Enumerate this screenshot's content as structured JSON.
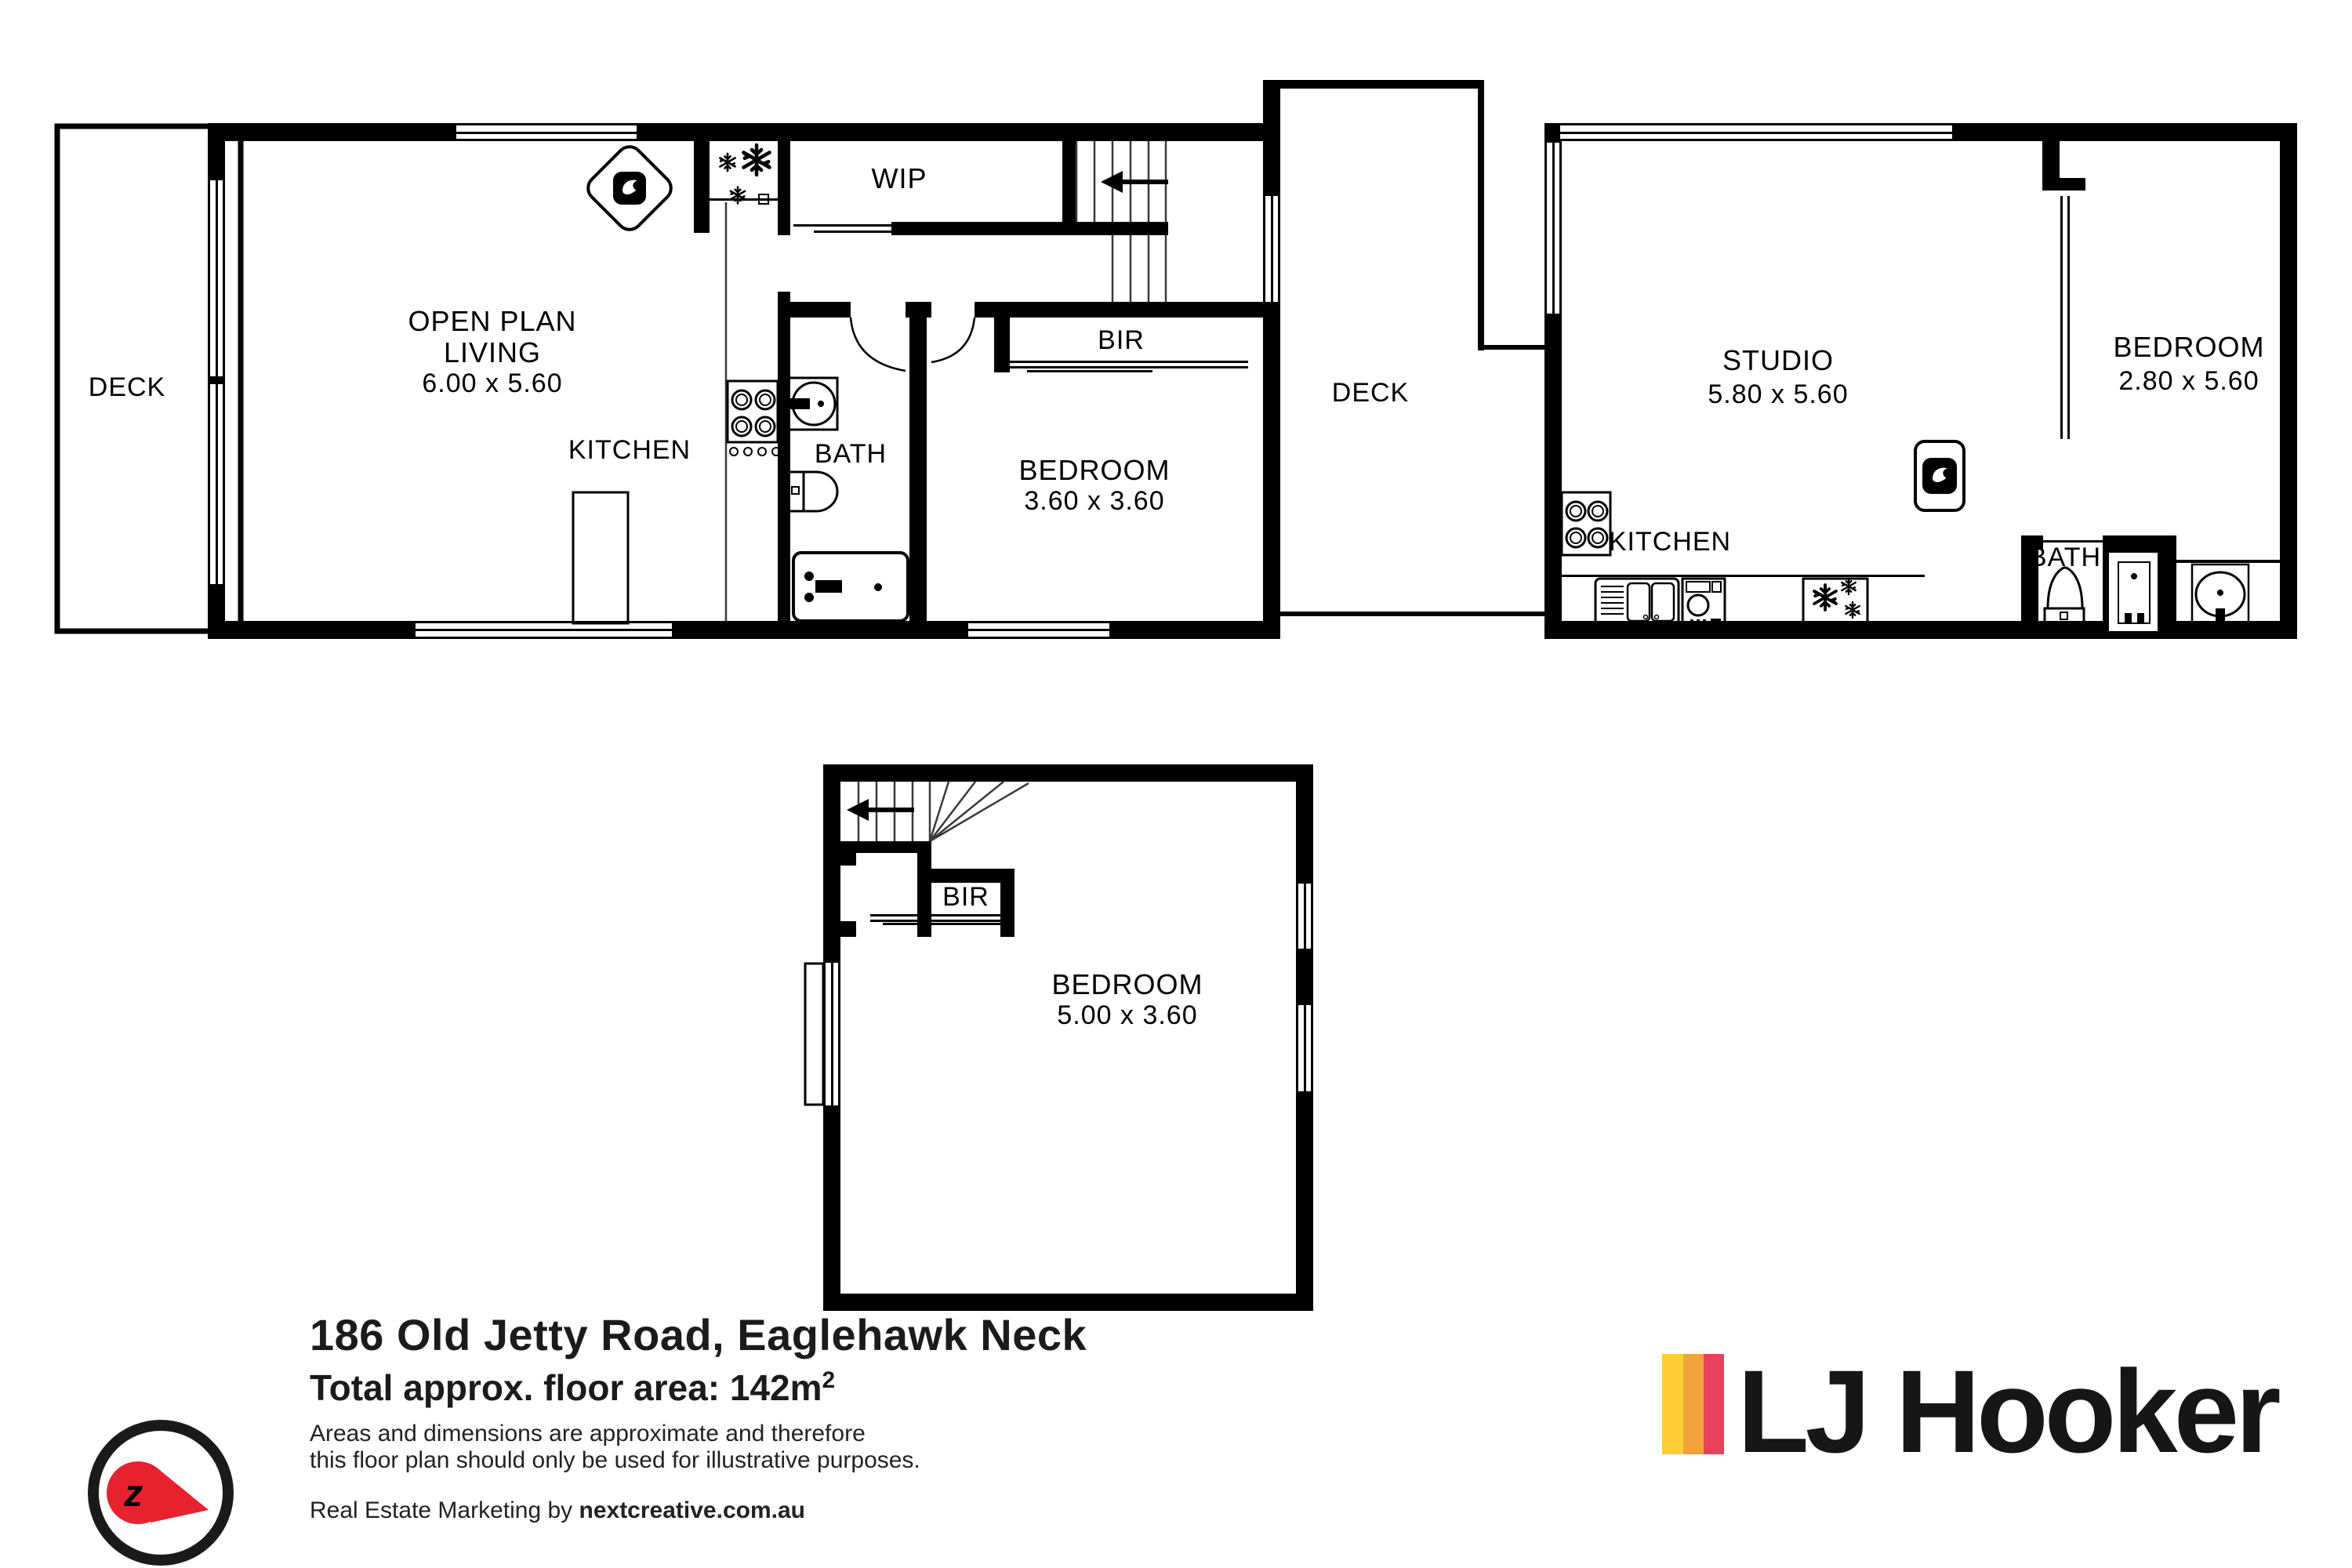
{
  "plan": {
    "main": {
      "deck_left_label": "DECK",
      "living_line1": "OPEN PLAN",
      "living_line2": "LIVING",
      "living_dims": "6.00 x 5.60",
      "kitchen_label": "KITCHEN",
      "wip_label": "WIP",
      "bath_label": "BATH",
      "bir_label": "BIR",
      "bedroom_label": "BEDROOM",
      "bedroom_dims": "3.60 x 3.60",
      "deck_mid_label": "DECK",
      "studio_label": "STUDIO",
      "studio_dims": "5.80 x 5.60",
      "kitchen_right_label": "KITCHEN",
      "bath_right_label": "BATH",
      "bedroom_right_label": "BEDROOM",
      "bedroom_right_dims": "2.80 x 5.60"
    },
    "lower": {
      "bir_label": "BIR",
      "bedroom_label": "BEDROOM",
      "bedroom_dims": "5.00 x 3.60"
    },
    "icons": {
      "fridge_icon": "snowflakes",
      "wood_heater_icon": "flame-in-diamond",
      "heat_pump_icon": "flame-in-square",
      "stair_direction_icon": "arrow-left",
      "cooktop_icon": "four-burners",
      "sink_icon": "double-bowl-sink",
      "dishwasher_icon": "front-load-appliance"
    }
  },
  "footer": {
    "address": "186 Old Jetty Road, Eaglehawk Neck",
    "area_label": "Total approx. floor area: 142m",
    "area_sup": "2",
    "disclaimer_line1": "Areas and dimensions are approximate and therefore",
    "disclaimer_line2": "this floor plan should only be used for illustrative purposes.",
    "marketing_prefix": "Real Estate Marketing by ",
    "marketing_brand": "nextcreative.com.au",
    "logo_text": "LJ Hooker",
    "compass_letter": "z",
    "colors": {
      "stripe_yellow": "#FFCE34",
      "stripe_orange": "#F2A33B",
      "stripe_red": "#E8415A",
      "compass_red": "#E8212F",
      "ink": "#000000"
    }
  }
}
